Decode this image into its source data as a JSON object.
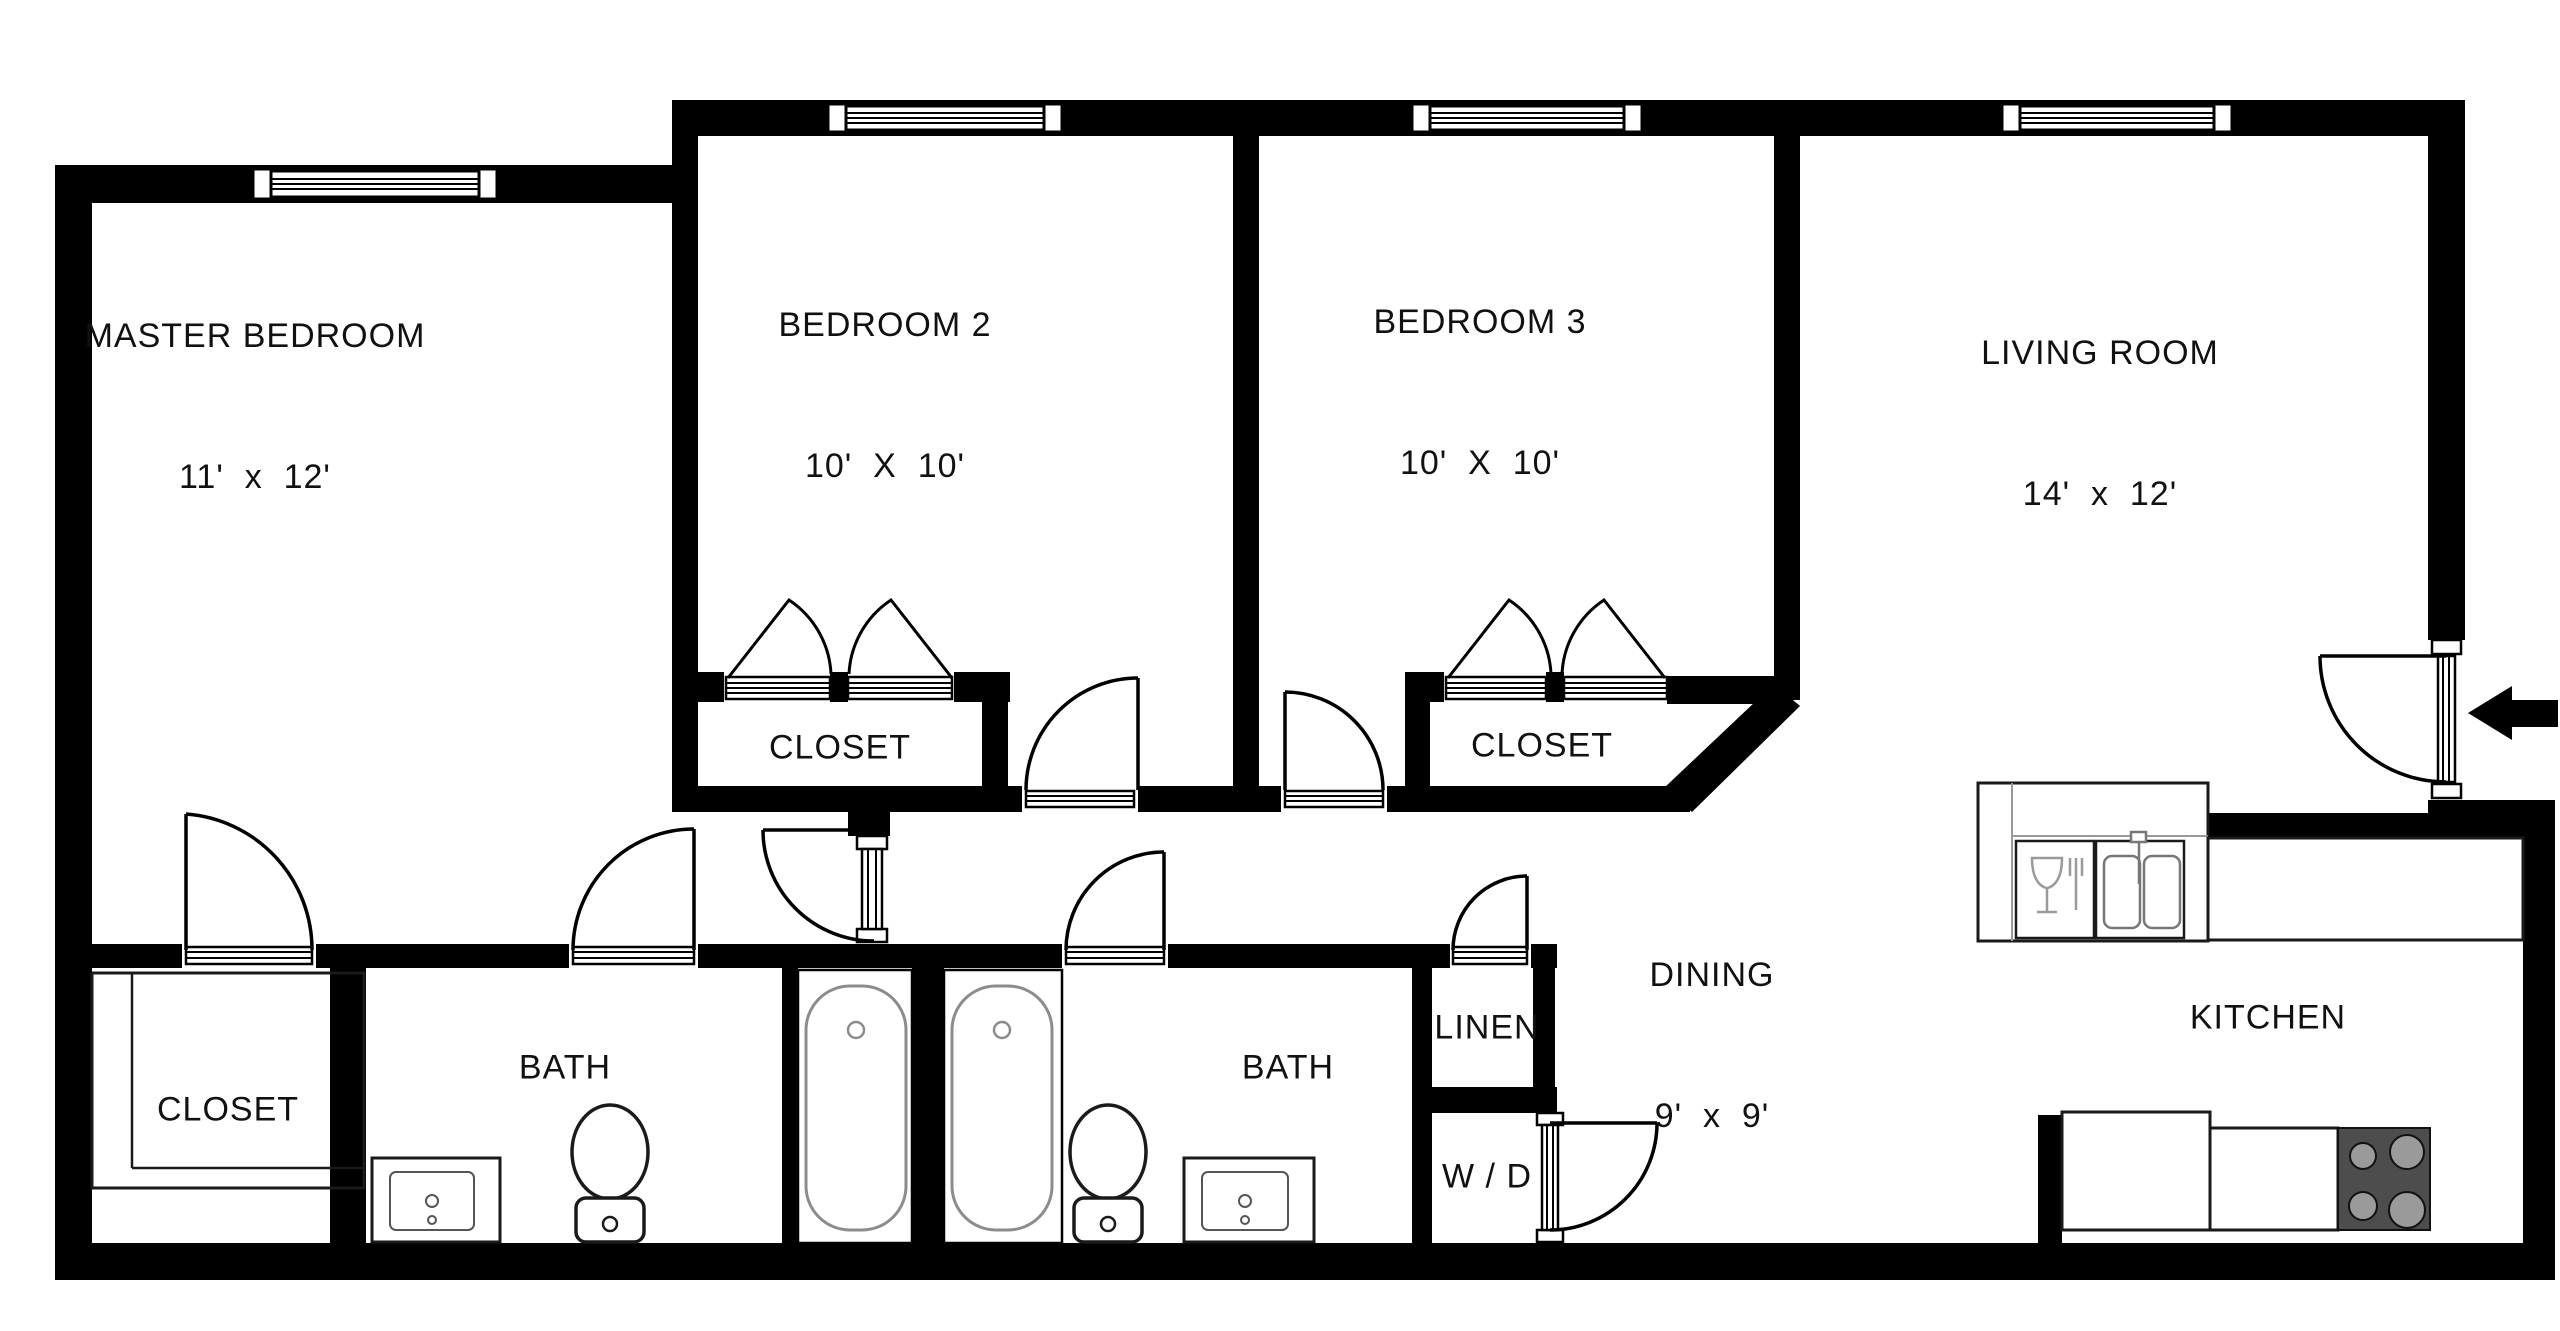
{
  "plan": {
    "colors": {
      "background": "#ffffff",
      "wall": "#000000",
      "fixture_outline": "#8c8c8c",
      "stove": "#4d4d4d",
      "burner": "#9a9a9a",
      "text": "#111111"
    },
    "rooms": [
      {
        "id": "master-bedroom",
        "label": "MASTER BEDROOM",
        "dims": "11'  x  12'"
      },
      {
        "id": "bedroom-2",
        "label": "BEDROOM 2",
        "dims": "10'  X  10'"
      },
      {
        "id": "bedroom-3",
        "label": "BEDROOM 3",
        "dims": "10'  X  10'"
      },
      {
        "id": "living-room",
        "label": "LIVING ROOM",
        "dims": "14'  x  12'"
      },
      {
        "id": "closet-bedroom-2",
        "label": "CLOSET"
      },
      {
        "id": "closet-bedroom-3",
        "label": "CLOSET"
      },
      {
        "id": "closet-master",
        "label": "CLOSET"
      },
      {
        "id": "bath-master",
        "label": "BATH"
      },
      {
        "id": "bath-hall",
        "label": "BATH"
      },
      {
        "id": "linen",
        "label": "LINEN"
      },
      {
        "id": "washer-dryer",
        "label": "W / D"
      },
      {
        "id": "dining",
        "label": "DINING",
        "dims": "9'  x  9'"
      },
      {
        "id": "kitchen",
        "label": "KITCHEN"
      }
    ],
    "icons": {
      "entry_arrow": "solid left-pointing arrow marking the apartment entry door"
    }
  }
}
